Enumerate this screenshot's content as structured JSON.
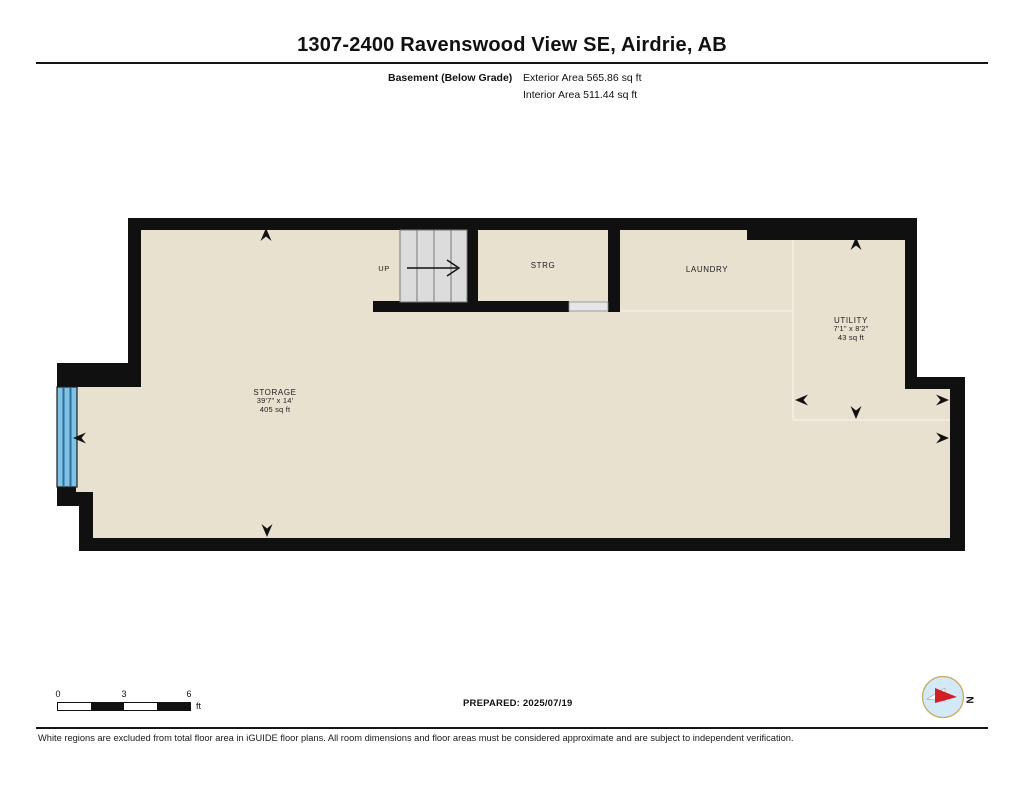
{
  "header": {
    "title": "1307-2400 Ravenswood View SE, Airdrie, AB",
    "floor_label": "Basement (Below Grade)",
    "exterior_area": "Exterior Area 565.86 sq ft",
    "interior_area": "Interior Area 511.44 sq ft"
  },
  "rooms": {
    "up": {
      "label": "UP"
    },
    "strg": {
      "label": "STRG"
    },
    "laundry": {
      "label": "LAUNDRY"
    },
    "utility": {
      "name": "UTILITY",
      "dimensions": "7'1\" x 8'2\"",
      "area": "43 sq ft"
    },
    "storage": {
      "name": "STORAGE",
      "dimensions": "39'7\" x 14'",
      "area": "405 sq ft"
    }
  },
  "scale_bar": {
    "ticks": [
      "0",
      "3",
      "6"
    ],
    "unit": "ft"
  },
  "footer": {
    "prepared_label": "PREPARED: 2025/07/19",
    "disclaimer": "White regions are excluded from total floor area in iGUIDE floor plans. All room dimensions and floor areas must be considered approximate and are subject to independent verification."
  },
  "compass": {
    "north_label": "N"
  },
  "colors": {
    "floor": "#e9e1d0",
    "wall": "#101010",
    "stairs": "#dcdcdc",
    "window_blue": "#7fc2e6",
    "window_stripe": "#2e6f9a",
    "compass_fill": "#d3e9f7",
    "compass_ring": "#c9ab5f",
    "compass_red": "#d22027"
  }
}
